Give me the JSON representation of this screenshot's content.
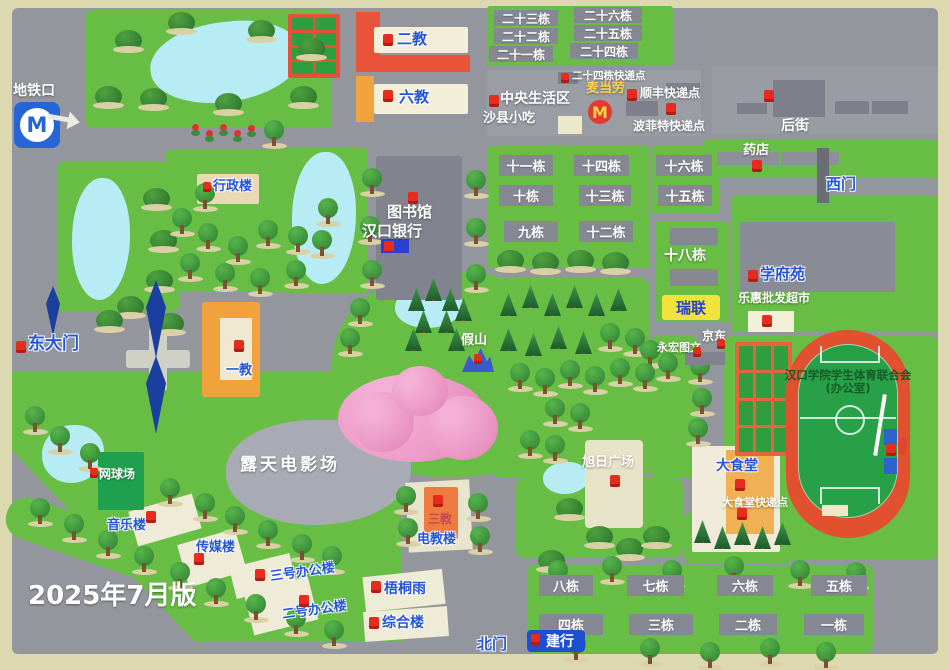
{
  "version": "2025年7月版",
  "colors": {
    "lawn": "#68bd45",
    "road": "#94969e",
    "accent_blue": "#2455d6",
    "pin_red": "#e62c1e",
    "water": "#b7ecf4",
    "track_red": "#e2512f",
    "field_green": "#28a047",
    "ruilian_yellow": "#f2e23c"
  },
  "metro": {
    "label": "地铁口",
    "logo": "M"
  },
  "gates": {
    "east": "东大门",
    "west": "西门",
    "north": "北门"
  },
  "teaching": {
    "t1": "一教",
    "t2": "二教",
    "t3": "三教",
    "t6": "六教",
    "etech": "电教楼",
    "admin": "行政楼",
    "library": "图书馆",
    "music": "音乐楼",
    "media": "传媒楼",
    "office3": "三号办公楼",
    "office2": "二号办公楼",
    "wutong": "梧桐雨",
    "zonghe": "综合楼"
  },
  "services": {
    "hankou_bank": "汉口银行",
    "ccb_bank": "建行",
    "pharmacy": "药店",
    "mcdonalds": "麦当劳",
    "mcd_logo": "M",
    "shaxian": "沙县小吃",
    "central_living": "中央生活区",
    "express_24": "二十四栋快递点",
    "sf_express": "顺丰快递点",
    "bofeite_express": "波菲特快递点",
    "back_street": "后街",
    "supermarket": "乐惠批发超市",
    "jd": "京东",
    "yonghong": "永宏图文",
    "ruilian": "瑞联",
    "canteen": "大食堂",
    "canteen_express": "大食堂快递点"
  },
  "landmarks": {
    "cinema": "露天电影场",
    "tennis": "网球场",
    "plaza": "旭日广场",
    "rockery": "假山",
    "xuefuyuan": "学府苑",
    "sports_assoc_line1": "汉口学院学生体育联合会",
    "sports_assoc_line2": "(办公室)"
  },
  "dorms_north": [
    "二十三栋",
    "二十六栋",
    "二十二栋",
    "二十五栋",
    "二十一栋",
    "二十四栋"
  ],
  "dorms_mid": [
    "十一栋",
    "十四栋",
    "十六栋",
    "十栋",
    "十三栋",
    "十五栋",
    "九栋",
    "十二栋"
  ],
  "dorm_18": "十八栋",
  "dorms_south": [
    "八栋",
    "七栋",
    "六栋",
    "五栋",
    "四栋",
    "三栋",
    "二栋",
    "一栋"
  ]
}
